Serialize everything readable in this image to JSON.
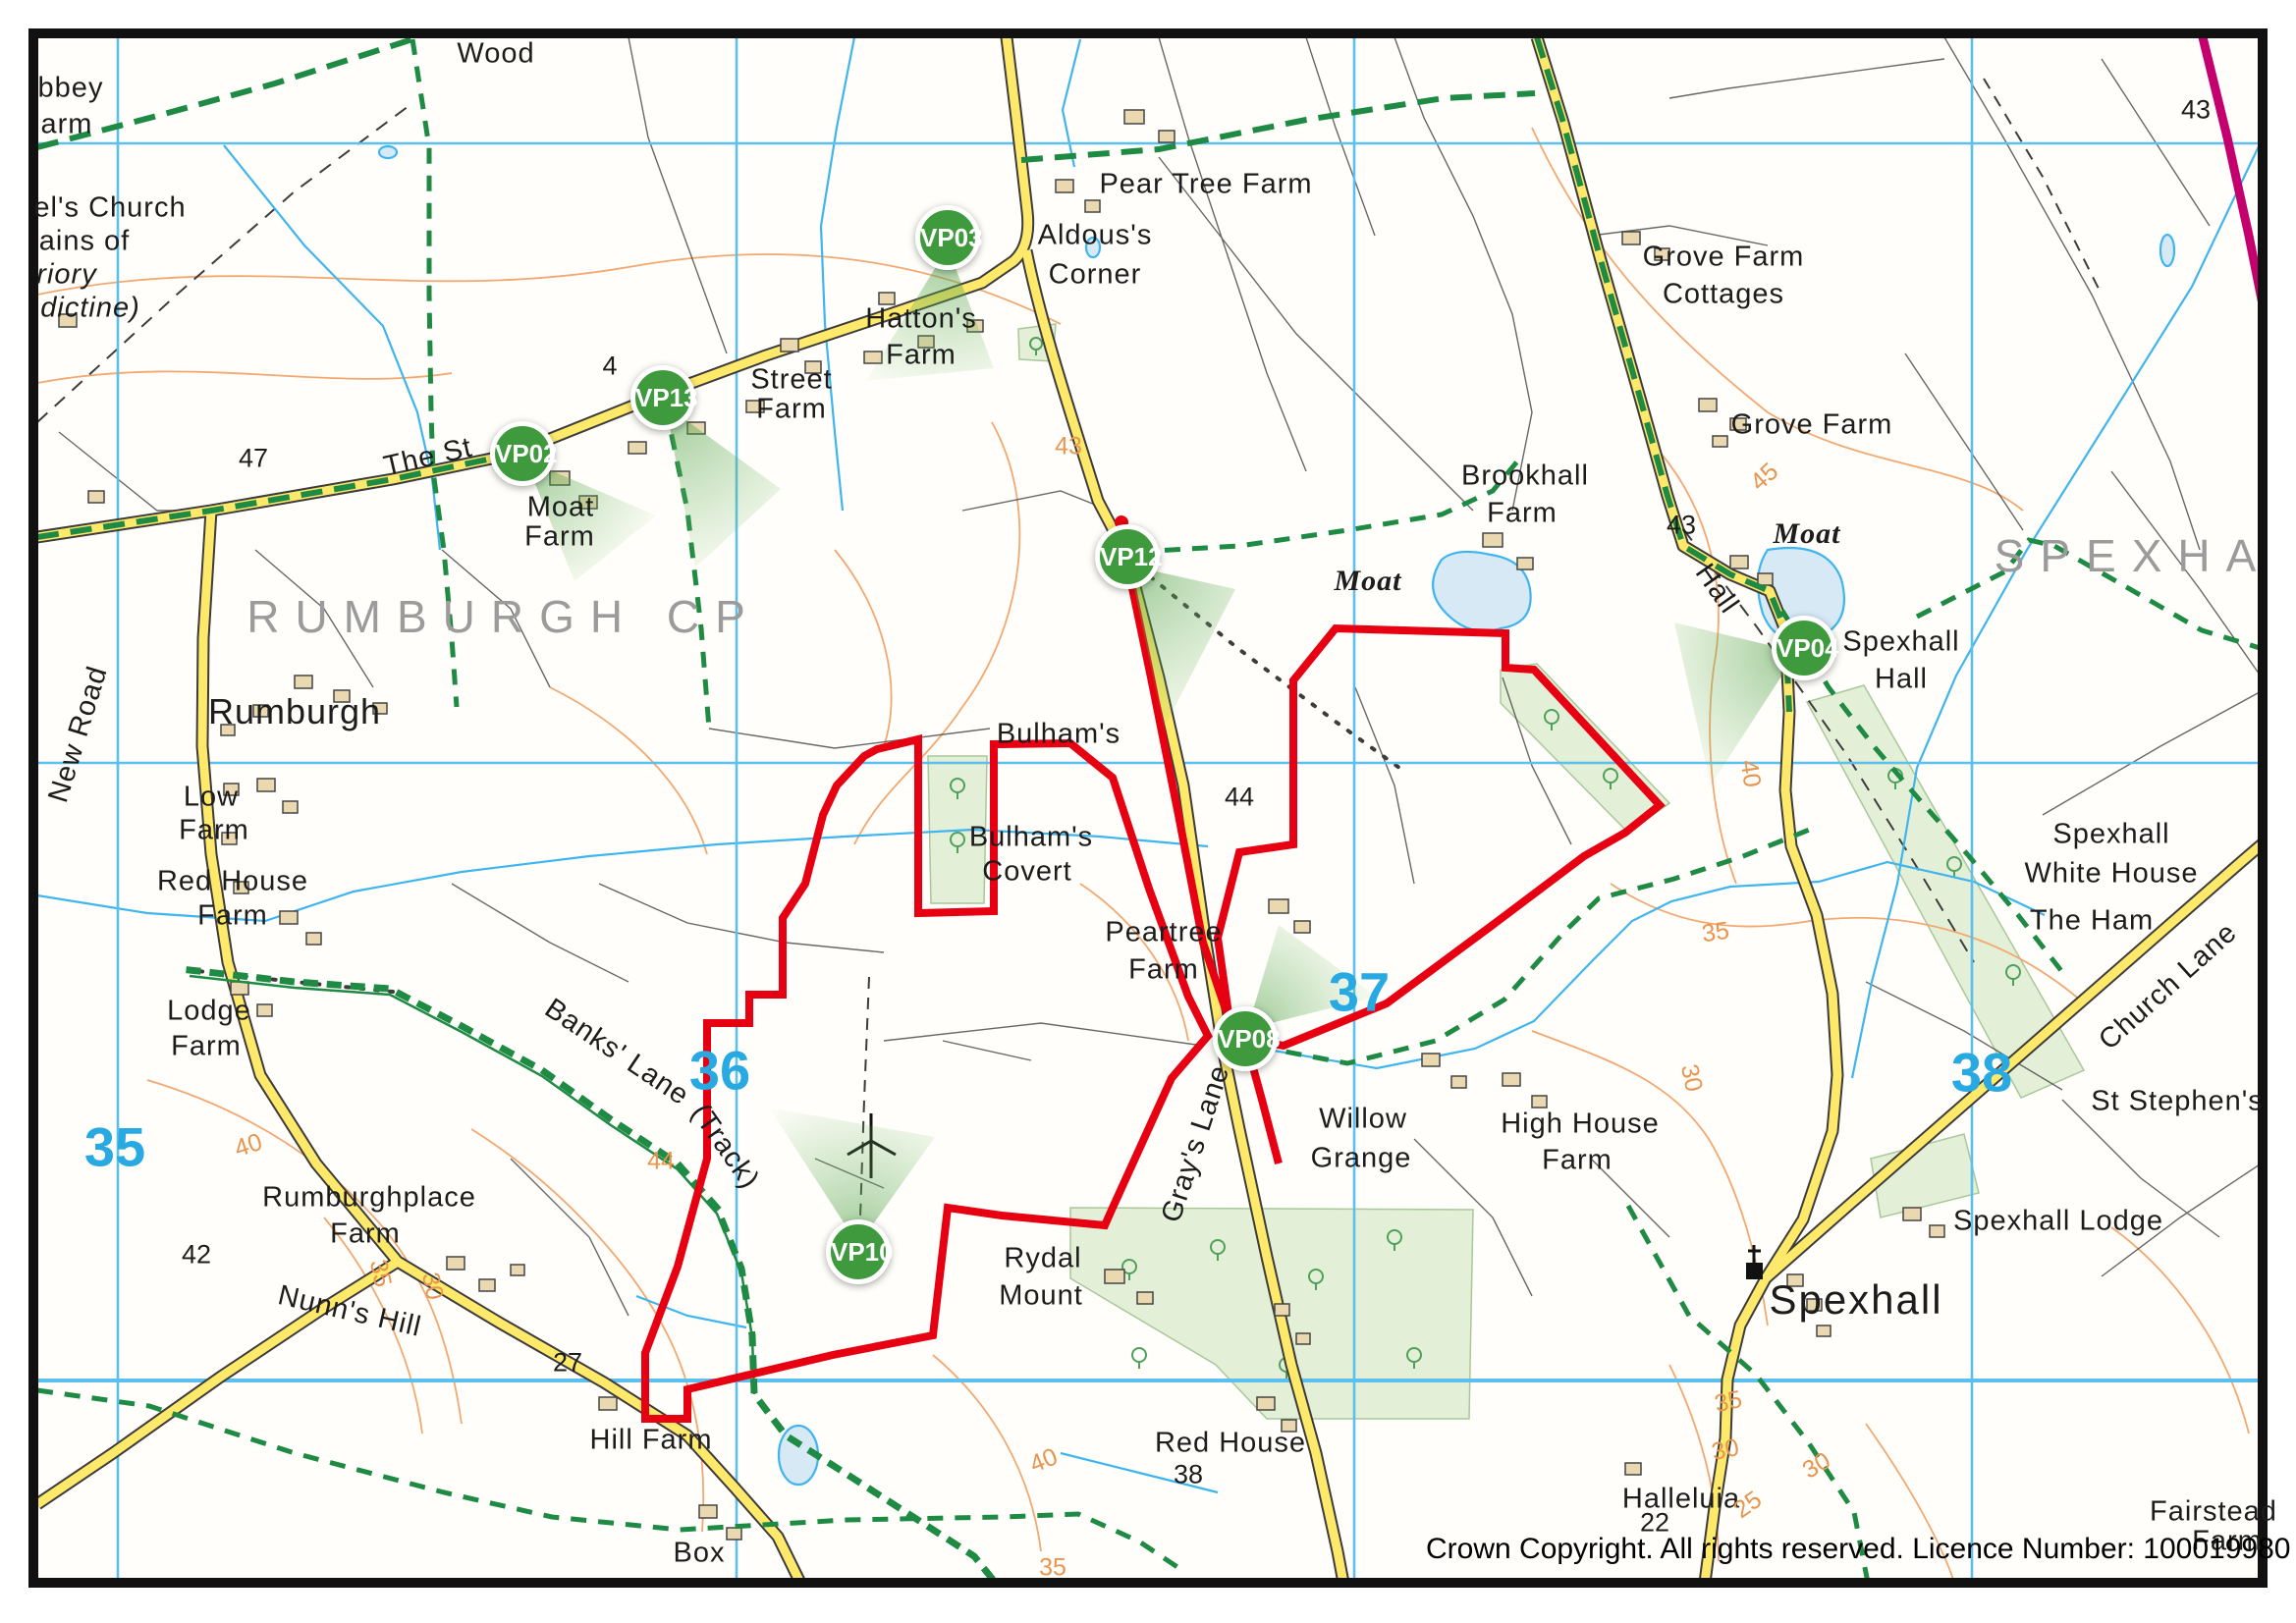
{
  "frame": {
    "copyright": "Crown Copyright. All rights reserved. Licence Number: 100019980"
  },
  "palette": {
    "road_yellow": "#FFE96B",
    "road_casing": "#3C3C3C",
    "site_boundary_red": "#E60012",
    "viewpoint_green": "#3E9A3C",
    "bridleway_green": "#1F8A44",
    "grid_blue": "#5BC0EE",
    "grid_number_blue": "#29A9E1",
    "contour_orange": "#F2A870",
    "water_blue": "#3FB5EF",
    "boundary_magenta": "#C4006E",
    "area_name_gray": "#9B9B9B"
  },
  "viewpoints": [
    {
      "id": "VP02"
    },
    {
      "id": "VP03"
    },
    {
      "id": "VP13"
    },
    {
      "id": "VP12"
    },
    {
      "id": "VP04"
    },
    {
      "id": "VP08"
    },
    {
      "id": "VP10"
    }
  ],
  "area_names": [
    {
      "text": "RUMBURGH CP"
    },
    {
      "text": "SPEXHA"
    }
  ],
  "grid_numbers": [
    {
      "text": "35"
    },
    {
      "text": "36"
    },
    {
      "text": "37"
    },
    {
      "text": "38"
    }
  ],
  "places": [
    {
      "text": "Wood"
    },
    {
      "text": "bbey"
    },
    {
      "text": "arm"
    },
    {
      "text": "el's Church"
    },
    {
      "text": "ains of"
    },
    {
      "text": "riory"
    },
    {
      "text": "dictine)"
    },
    {
      "text": "Pear Tree Farm"
    },
    {
      "text": "Aldous's"
    },
    {
      "text": "Corner"
    },
    {
      "text": "Hatton's"
    },
    {
      "text": "Farm"
    },
    {
      "text": "Street"
    },
    {
      "text": "Farm"
    },
    {
      "text": "The St"
    },
    {
      "text": "Moat"
    },
    {
      "text": "Farm"
    },
    {
      "text": "Grove Farm"
    },
    {
      "text": "Cottages"
    },
    {
      "text": "Grove Farm"
    },
    {
      "text": "Brookhall"
    },
    {
      "text": "Farm"
    },
    {
      "text": "Spexhall"
    },
    {
      "text": "Hall"
    },
    {
      "text": "Hall"
    },
    {
      "text": "Rumburgh"
    },
    {
      "text": "New Road"
    },
    {
      "text": "Low"
    },
    {
      "text": "Farm"
    },
    {
      "text": "Red House"
    },
    {
      "text": "Farm"
    },
    {
      "text": "Lodge"
    },
    {
      "text": "Farm"
    },
    {
      "text": "Bulham's"
    },
    {
      "text": "Bulham's"
    },
    {
      "text": "Covert"
    },
    {
      "text": "Peartree"
    },
    {
      "text": "Farm"
    },
    {
      "text": "Willow"
    },
    {
      "text": "Grange"
    },
    {
      "text": "High House"
    },
    {
      "text": "Farm"
    },
    {
      "text": "Spexhall"
    },
    {
      "text": "White House"
    },
    {
      "text": "The Ham"
    },
    {
      "text": "Church Lane"
    },
    {
      "text": "St Stephen's"
    },
    {
      "text": "Spexhall Lodge"
    },
    {
      "text": "Spexhall"
    },
    {
      "text": "Banks' Lane"
    },
    {
      "text": "(Track)"
    },
    {
      "text": "Rumburghplace"
    },
    {
      "text": "Farm"
    },
    {
      "text": "Nunn's Hill"
    },
    {
      "text": "Hill Farm"
    },
    {
      "text": "Box"
    },
    {
      "text": "Red House"
    },
    {
      "text": "Rydal"
    },
    {
      "text": "Mount"
    },
    {
      "text": "Gray's Lane"
    },
    {
      "text": "Halleluia"
    },
    {
      "text": "Fairstead"
    },
    {
      "text": "Farm"
    },
    {
      "text": "Moat"
    },
    {
      "text": "Moat"
    }
  ],
  "contour_labels": [
    {
      "text": "43"
    },
    {
      "text": "45"
    },
    {
      "text": "40"
    },
    {
      "text": "35"
    },
    {
      "text": "30"
    },
    {
      "text": "40"
    },
    {
      "text": "44"
    },
    {
      "text": "35"
    },
    {
      "text": "30"
    },
    {
      "text": "40"
    },
    {
      "text": "35"
    },
    {
      "text": "35"
    },
    {
      "text": "30"
    },
    {
      "text": "25"
    },
    {
      "text": "30"
    }
  ],
  "spot_heights": [
    {
      "text": "47"
    },
    {
      "text": "43"
    },
    {
      "text": "43"
    },
    {
      "text": "44"
    },
    {
      "text": "42"
    },
    {
      "text": "27"
    },
    {
      "text": "38"
    },
    {
      "text": "22"
    },
    {
      "text": "4"
    }
  ]
}
